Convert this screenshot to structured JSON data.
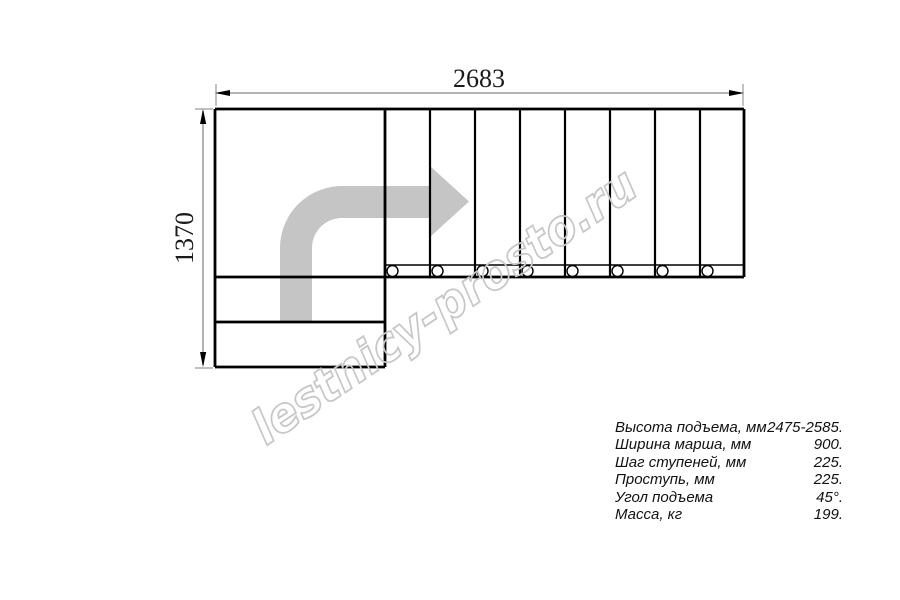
{
  "drawing": {
    "width_dim_label": "2683",
    "height_dim_label": "1370",
    "watermark": "lestnicy-prosto.ru",
    "tread_count": 8,
    "colors": {
      "outline": "#000000",
      "dim_line": "#9a9a9a",
      "arrow_fill": "#c5c5c5",
      "watermark_stroke": "#c7c7c7"
    }
  },
  "specs": {
    "rows": [
      {
        "label": "Высота подъема, мм",
        "value": "2475-2585."
      },
      {
        "label": "Ширина марша, мм",
        "value": "900."
      },
      {
        "label": "Шаг ступеней, мм",
        "value": "225."
      },
      {
        "label": "Проступь, мм",
        "value": "225."
      },
      {
        "label": "Угол подъема",
        "value": "45°."
      },
      {
        "label": "Масса, кг",
        "value": "199."
      }
    ]
  }
}
